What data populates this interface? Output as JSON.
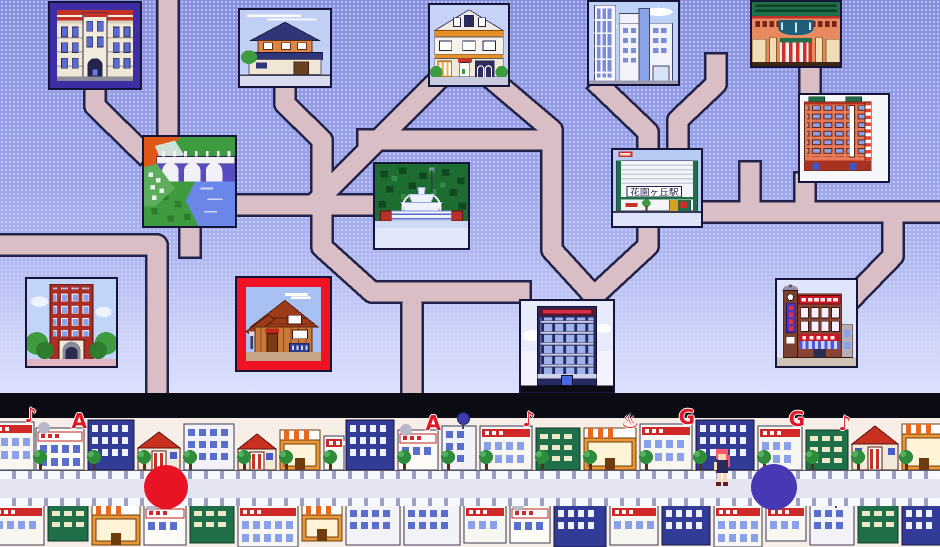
{
  "scene": {
    "title": "town map",
    "station_sign": "花園ヶ丘駅"
  },
  "map": {
    "tiles": [
      {
        "id": "school",
        "label": "school-building",
        "art": "school",
        "x": 50,
        "y": 3,
        "w": 90,
        "h": 85,
        "frame": "#3d2ea6",
        "frame_w": 7
      },
      {
        "id": "japanese-house",
        "label": "japanese-house",
        "art": "jp_house",
        "x": 238,
        "y": 8,
        "w": 94,
        "h": 80,
        "frame": null,
        "frame_w": 0
      },
      {
        "id": "shop-house",
        "label": "white-shop-house",
        "art": "shop_house",
        "x": 428,
        "y": 3,
        "w": 82,
        "h": 84,
        "frame": null,
        "frame_w": 0
      },
      {
        "id": "modern-building",
        "label": "modern-tower",
        "art": "modern",
        "x": 587,
        "y": 0,
        "w": 93,
        "h": 86,
        "frame": null,
        "frame_w": 0
      },
      {
        "id": "department-store",
        "label": "department-store",
        "art": "dept",
        "x": 750,
        "y": 0,
        "w": 92,
        "h": 68,
        "frame": null,
        "frame_w": 0
      },
      {
        "id": "bridge",
        "label": "river-bridge",
        "art": "bridge",
        "x": 142,
        "y": 135,
        "w": 95,
        "h": 93,
        "frame": null,
        "frame_w": 0
      },
      {
        "id": "fountain",
        "label": "park-fountain",
        "art": "fountain",
        "x": 373,
        "y": 162,
        "w": 97,
        "h": 88,
        "frame": null,
        "frame_w": 0
      },
      {
        "id": "station",
        "label": "hanazonogaoka-station",
        "art": "station",
        "x": 611,
        "y": 148,
        "w": 92,
        "h": 80,
        "frame": null,
        "frame_w": 0
      },
      {
        "id": "red-tower",
        "label": "apartment-tower",
        "art": "red_tower",
        "x": 798,
        "y": 93,
        "w": 92,
        "h": 90,
        "frame": null,
        "frame_w": 0
      },
      {
        "id": "brick-apartment",
        "label": "brick-apartment",
        "art": "brick_apt",
        "x": 25,
        "y": 277,
        "w": 93,
        "h": 91,
        "frame": null,
        "frame_w": 0
      },
      {
        "id": "wood-house",
        "label": "wood-house-selected",
        "art": "wood_house",
        "x": 237,
        "y": 278,
        "w": 93,
        "h": 92,
        "frame": "#ee1222",
        "frame_w": 9
      },
      {
        "id": "office",
        "label": "office-building",
        "art": "office",
        "x": 519,
        "y": 299,
        "w": 96,
        "h": 95,
        "frame": null,
        "frame_w": 0
      },
      {
        "id": "theater",
        "label": "shopping-theater",
        "art": "theater",
        "x": 775,
        "y": 278,
        "w": 83,
        "h": 90,
        "frame": null,
        "frame_w": 0
      }
    ]
  },
  "street": {
    "top_row": [
      {
        "x": -14,
        "w": 48,
        "h": 48,
        "style": "shop",
        "glyph": "♪"
      },
      {
        "x": 36,
        "w": 48,
        "h": 42,
        "style": "pachinko",
        "glyph": "A"
      },
      {
        "x": 88,
        "w": 46,
        "h": 50,
        "style": "apt_blue"
      },
      {
        "x": 138,
        "w": 42,
        "h": 38,
        "style": "house"
      },
      {
        "x": 184,
        "w": 50,
        "h": 46,
        "style": "apt_white"
      },
      {
        "x": 238,
        "w": 38,
        "h": 36,
        "style": "house"
      },
      {
        "x": 280,
        "w": 40,
        "h": 40,
        "style": "awning"
      },
      {
        "x": 324,
        "w": 20,
        "h": 34,
        "style": "shop"
      },
      {
        "x": 346,
        "w": 48,
        "h": 50,
        "style": "apt_blue"
      },
      {
        "x": 398,
        "w": 40,
        "h": 40,
        "style": "pachinko",
        "glyph": "A"
      },
      {
        "x": 442,
        "w": 34,
        "h": 44,
        "style": "apt_white",
        "ball": true
      },
      {
        "x": 480,
        "w": 52,
        "h": 44,
        "style": "shop",
        "glyph": "♪"
      },
      {
        "x": 536,
        "w": 44,
        "h": 42,
        "style": "green"
      },
      {
        "x": 584,
        "w": 52,
        "h": 42,
        "style": "awning",
        "glyph": "♨"
      },
      {
        "x": 640,
        "w": 52,
        "h": 46,
        "style": "shop",
        "glyph": "G"
      },
      {
        "x": 696,
        "w": 58,
        "h": 50,
        "style": "apt_blue"
      },
      {
        "x": 758,
        "w": 44,
        "h": 44,
        "style": "shop",
        "glyph": "G"
      },
      {
        "x": 806,
        "w": 42,
        "h": 40,
        "style": "green",
        "glyph": "♪"
      },
      {
        "x": 852,
        "w": 46,
        "h": 44,
        "style": "house"
      },
      {
        "x": 902,
        "w": 44,
        "h": 46,
        "style": "awning"
      }
    ],
    "bottom_row": [
      {
        "x": -8,
        "w": 52,
        "h": 40,
        "style": "shop",
        "glyph": "♪"
      },
      {
        "x": 48,
        "w": 40,
        "h": 36,
        "style": "green"
      },
      {
        "x": 92,
        "w": 48,
        "h": 40,
        "style": "awning",
        "glyph": "♨"
      },
      {
        "x": 144,
        "w": 42,
        "h": 40,
        "style": "pachinko",
        "glyph": "A"
      },
      {
        "x": 190,
        "w": 44,
        "h": 38,
        "style": "green"
      },
      {
        "x": 238,
        "w": 60,
        "h": 42,
        "style": "shop",
        "glyph": "♪"
      },
      {
        "x": 302,
        "w": 40,
        "h": 36,
        "style": "awning"
      },
      {
        "x": 346,
        "w": 54,
        "h": 40,
        "style": "apt_white"
      },
      {
        "x": 404,
        "w": 56,
        "h": 40,
        "style": "apt_white"
      },
      {
        "x": 464,
        "w": 42,
        "h": 38,
        "style": "shop"
      },
      {
        "x": 510,
        "w": 40,
        "h": 38,
        "style": "pachinko",
        "glyph": "A"
      },
      {
        "x": 554,
        "w": 52,
        "h": 42,
        "style": "apt_blue"
      },
      {
        "x": 610,
        "w": 48,
        "h": 40,
        "style": "shop",
        "glyph": "G"
      },
      {
        "x": 662,
        "w": 48,
        "h": 40,
        "style": "apt_blue"
      },
      {
        "x": 714,
        "w": 48,
        "h": 42,
        "style": "shop",
        "glyph": "G"
      },
      {
        "x": 766,
        "w": 40,
        "h": 36,
        "style": "shop"
      },
      {
        "x": 810,
        "w": 44,
        "h": 40,
        "style": "apt_white",
        "ball": true
      },
      {
        "x": 858,
        "w": 40,
        "h": 38,
        "style": "green"
      },
      {
        "x": 902,
        "w": 42,
        "h": 40,
        "style": "apt_blue"
      }
    ],
    "trees": [
      32,
      86,
      136,
      182,
      236,
      278,
      322,
      396,
      440,
      478,
      534,
      582,
      638,
      692,
      756,
      804,
      850,
      898
    ]
  },
  "markers": [
    {
      "id": "red",
      "color": "#e81325",
      "x": 166,
      "y": 487,
      "r": 22
    },
    {
      "id": "indigo",
      "color": "#4739b4",
      "x": 774,
      "y": 487,
      "r": 23
    }
  ],
  "character": {
    "id": "pink-hair-girl",
    "x": 712,
    "y": 447
  },
  "palette": {
    "road": "#d9bfc5",
    "road_outline": "#23234a",
    "black_band": "#0b0b14",
    "street_bg": "#f7efe7",
    "track": "#e4e4f2",
    "sign_red": "#e01624",
    "marker_red": "#e81325",
    "marker_indigo": "#4739b4"
  }
}
